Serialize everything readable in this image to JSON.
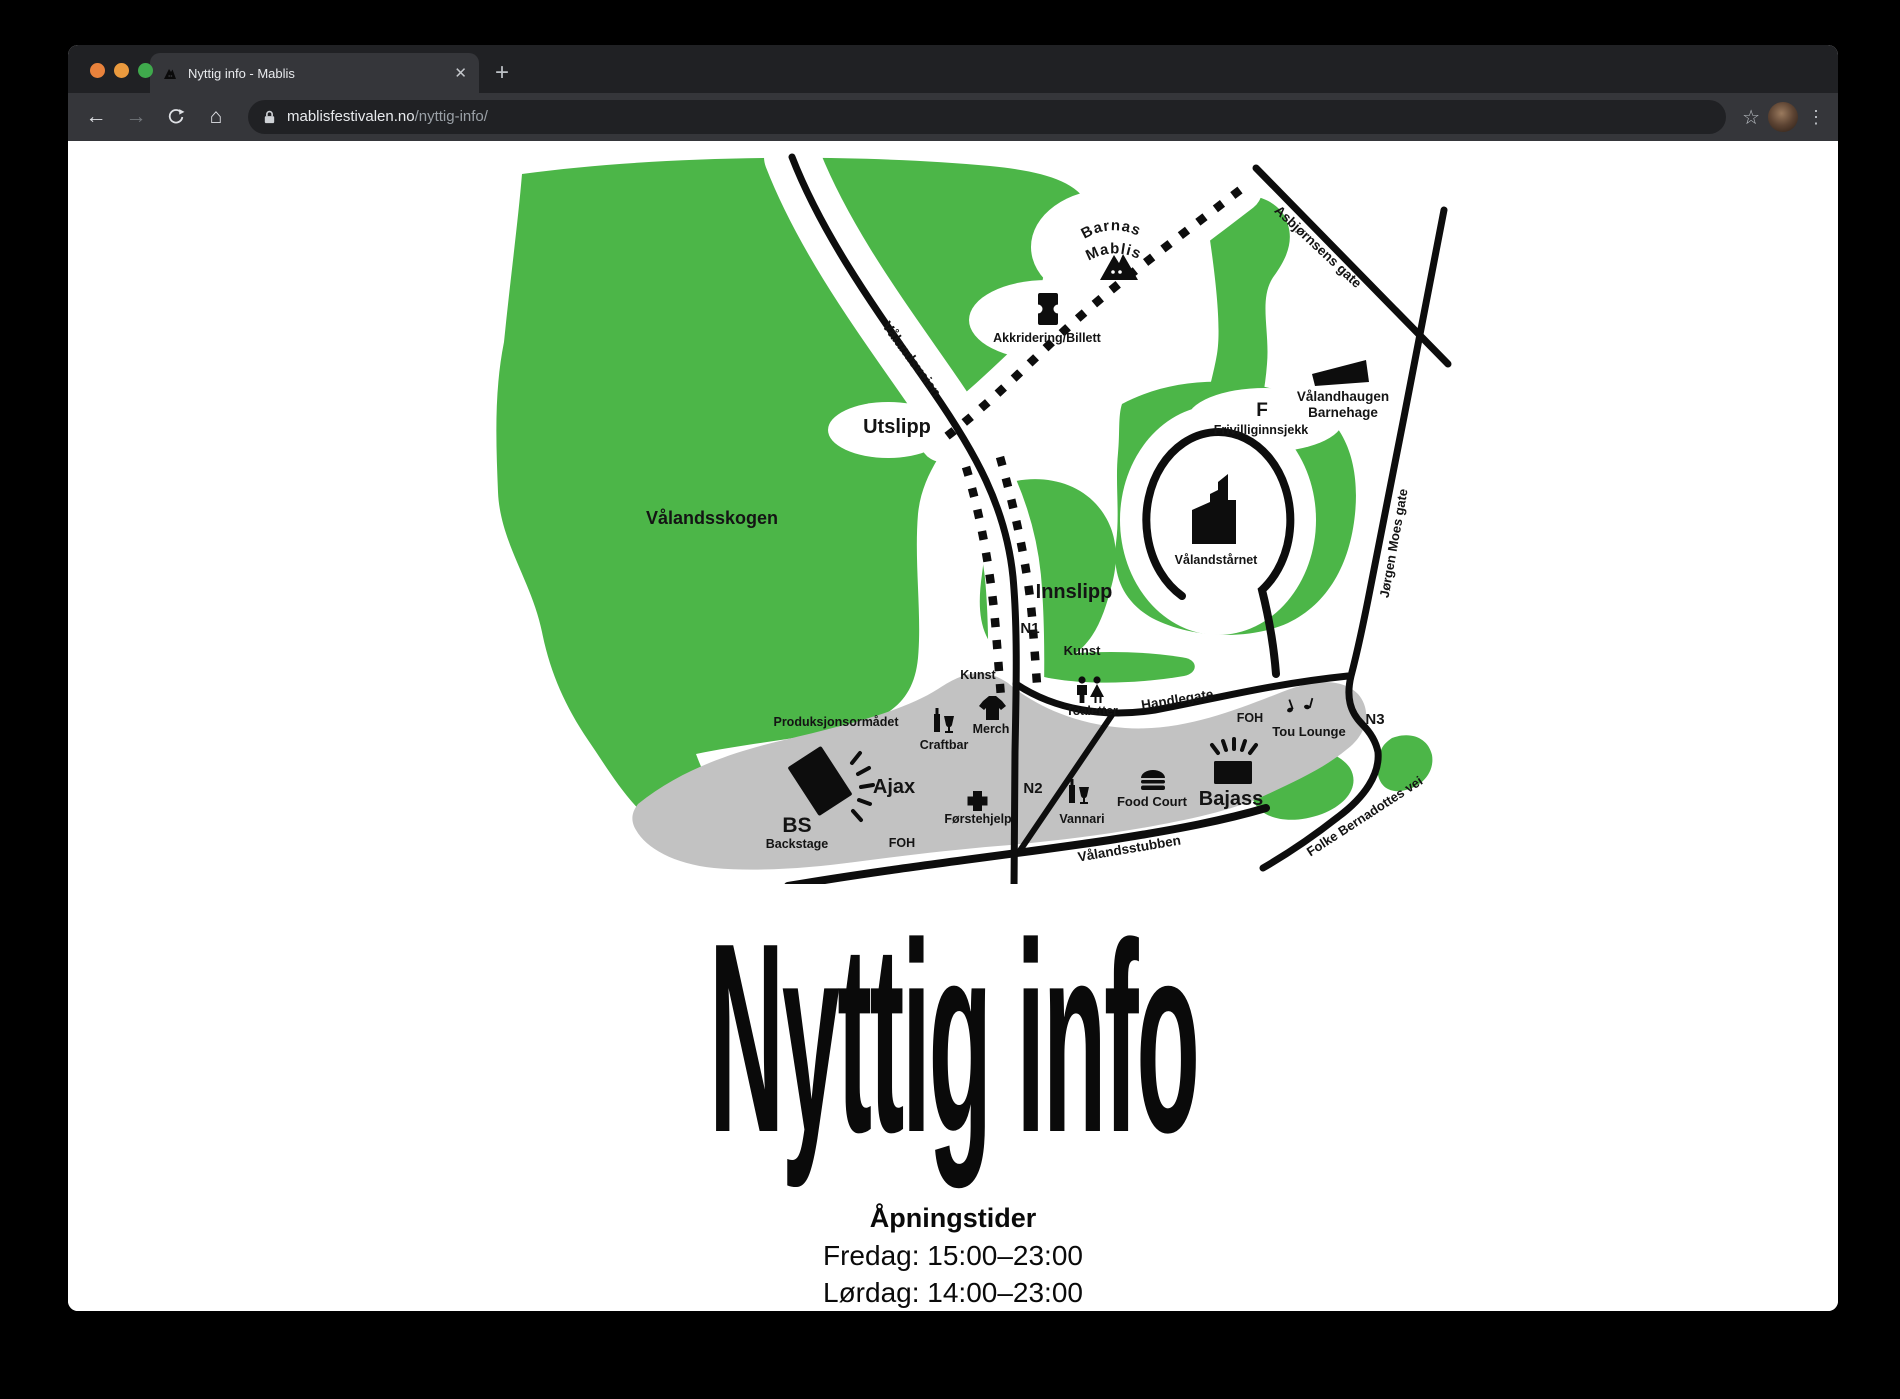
{
  "colors": {
    "map_green": "#4CB648",
    "map_gray": "#C2C2C2",
    "map_road": "#0D0D0D",
    "traffic_red": "#E8823C",
    "traffic_yellow": "#EA9A3E",
    "traffic_green": "#3FA94C"
  },
  "browser": {
    "tab_title": "Nyttig info - Mablis",
    "close_glyph": "✕",
    "newtab_glyph": "+",
    "back_glyph": "←",
    "forward_glyph": "→",
    "home_glyph": "⌂",
    "star_glyph": "☆",
    "kebab_glyph": "⋮",
    "url_domain": "mablisfestivalen.no",
    "url_path": "/nyttig-info/"
  },
  "page": {
    "heading": "Nyttig info",
    "hours_title": "Åpningstider",
    "hours_line1": "Fredag: 15:00–23:00",
    "hours_line2": "Lørdag: 14:00–23:00"
  },
  "map": {
    "labels": {
      "forest": "Vålandsskogen",
      "valandsveien": "Vålandsveien",
      "utslipp": "Utslipp",
      "innslipp": "Innslipp",
      "barnas_line1": "Barnas",
      "barnas_line2": "Mablis",
      "akkreditering": "Akkridering/Billett",
      "asbjornsens": "Asbjørnsens gate",
      "barnehage_line1": "Vålandhaugen",
      "barnehage_line2": "Barnehage",
      "f": "F",
      "frivillig": "Frivilliginnsjekk",
      "taarnet": "Vålandstårnet",
      "kunst1": "Kunst",
      "kunst2": "Kunst",
      "toaletter": "Toaletter",
      "handlegate": "Handlegate",
      "foh_right": "FOH",
      "foh_left": "FOH",
      "tou": "Tou Lounge",
      "n1": "N1",
      "n2": "N2",
      "n3": "N3",
      "produksjon": "Produksjonsormådet",
      "merch": "Merch",
      "craftbar": "Craftbar",
      "ajax": "Ajax",
      "forstehjelp": "Førstehjelp",
      "vannari": "Vannari",
      "foodcourt": "Food Court",
      "bajass": "Bajass",
      "bs": "BS",
      "backstage": "Backstage",
      "stubben": "Vålandsstubben",
      "folke": "Folke Bernadottes vei",
      "jorgen": "Jørgen Moes gate"
    }
  }
}
